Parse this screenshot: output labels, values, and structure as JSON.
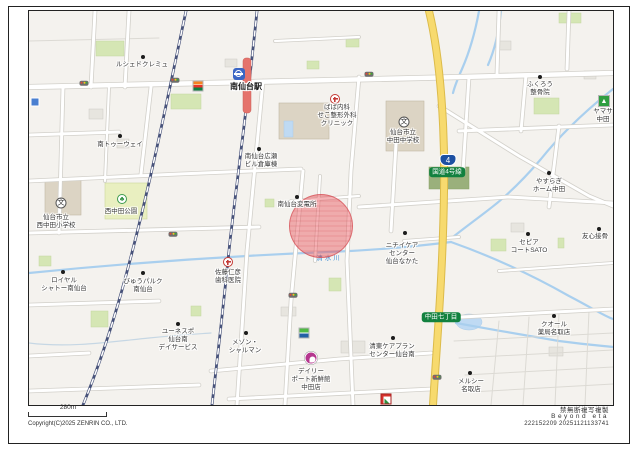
{
  "footer": {
    "scale_label": "280m",
    "copyright": "Copyright(C)2025 ZENRIN CO., LTD.",
    "no_copy_notice": "禁無断複写複製",
    "brand": "Beyond eta",
    "serial": "222152209 20251121133741"
  },
  "map": {
    "colors": {
      "background": "#f4f2ee",
      "route_yellow": "#f7da6e",
      "highlight_red": "#e85560",
      "badge_green": "#12813f",
      "shield_blue": "#1d50a2",
      "river_blue": "#a9cfee",
      "platform_red": "#e5736c"
    },
    "river_label": {
      "text": "清水川",
      "x": 300,
      "y": 246
    },
    "highlight_circle": {
      "x": 291,
      "y": 214,
      "r": 31,
      "fill": "rgba(232,85,92,0.45)",
      "border": "rgba(205,60,68,0.55)"
    },
    "road_labels": [
      {
        "type": "shield",
        "text": "4",
        "x": 419,
        "y": 149
      },
      {
        "type": "badge",
        "text": "国道4号線",
        "x": 418,
        "y": 161
      },
      {
        "type": "badge",
        "text": "中田七丁目",
        "x": 412,
        "y": 306
      }
    ],
    "signals": [
      [
        55,
        72
      ],
      [
        146,
        69
      ],
      [
        340,
        63
      ],
      [
        144,
        223
      ],
      [
        264,
        284
      ],
      [
        408,
        366
      ]
    ],
    "pois": [
      {
        "marker": "dot",
        "mx": 114,
        "my": 46,
        "lines": [
          "ルシェドクレミュ"
        ],
        "lx": 113,
        "ly": 50
      },
      {
        "marker": "dot",
        "mx": 91,
        "my": 125,
        "lines": [
          "南トゥーウェイ"
        ],
        "lx": 91,
        "ly": 130
      },
      {
        "marker": "station",
        "mx": 210,
        "my": 63,
        "lines": [
          "南仙台駅"
        ],
        "lx": 217,
        "ly": 71,
        "cls": "station-label"
      },
      {
        "marker": "dot",
        "mx": 230,
        "my": 138,
        "lines": [
          "南仙台広瀬",
          "ビル倉庫棟"
        ],
        "lx": 232,
        "ly": 142
      },
      {
        "marker": "hospital",
        "mx": 306,
        "my": 88,
        "lines": [
          "ばば内科",
          "せこ整形外科",
          "クリニック"
        ],
        "lx": 308,
        "ly": 93
      },
      {
        "marker": "school",
        "mx": 375,
        "my": 111,
        "lines": [
          "仙台市立",
          "中田中学校"
        ],
        "lx": 374,
        "ly": 118
      },
      {
        "marker": "dot",
        "mx": 511,
        "my": 66,
        "lines": [
          "ふくろう",
          "整骨院"
        ],
        "lx": 511,
        "ly": 70
      },
      {
        "marker": "store-yamasa",
        "mx": 575,
        "my": 90,
        "lines": [
          "ヤマサ",
          "中田"
        ],
        "lx": 574,
        "ly": 97
      },
      {
        "marker": "dot",
        "mx": 520,
        "my": 162,
        "lines": [
          "やすらぎ",
          "ホーム中田"
        ],
        "lx": 520,
        "ly": 167
      },
      {
        "marker": "dot",
        "mx": 268,
        "my": 186,
        "lines": [
          "南仙台変電所"
        ],
        "lx": 268,
        "ly": 190
      },
      {
        "marker": "dot",
        "mx": 376,
        "my": 222,
        "lines": [
          "ニチイケア",
          "センター",
          "仙台なかた"
        ],
        "lx": 373,
        "ly": 231
      },
      {
        "marker": "dot",
        "mx": 499,
        "my": 223,
        "lines": [
          "セピア",
          "コートSATO"
        ],
        "lx": 500,
        "ly": 228
      },
      {
        "marker": "dot",
        "mx": 570,
        "my": 218,
        "lines": [
          "友心接骨"
        ],
        "lx": 566,
        "ly": 222
      },
      {
        "marker": "dot",
        "mx": 525,
        "my": 305,
        "lines": [
          "クオール",
          "薬局名取店"
        ],
        "lx": 525,
        "ly": 310
      },
      {
        "marker": "dot",
        "mx": 441,
        "my": 362,
        "lines": [
          "メルシー",
          "名取店"
        ],
        "lx": 442,
        "ly": 367
      },
      {
        "marker": "dot",
        "mx": 364,
        "my": 327,
        "lines": [
          "清東ケアプラン",
          "センター仙台南"
        ],
        "lx": 363,
        "ly": 332
      },
      {
        "marker": "store-daily",
        "mx": 282,
        "my": 347,
        "lines": [
          "デイリー",
          "ポート新鮮館",
          "中田店"
        ],
        "lx": 282,
        "ly": 357
      },
      {
        "marker": "dot",
        "mx": 217,
        "my": 322,
        "lines": [
          "メゾン・",
          "シャルマン"
        ],
        "lx": 216,
        "ly": 328
      },
      {
        "marker": "hospital",
        "mx": 199,
        "my": 251,
        "lines": [
          "佐藤仁彦",
          "歯科医院"
        ],
        "lx": 199,
        "ly": 258
      },
      {
        "marker": "dot",
        "mx": 149,
        "my": 313,
        "lines": [
          "ユーネスポ",
          "仙台南",
          "デイサービス"
        ],
        "lx": 149,
        "ly": 317
      },
      {
        "marker": "dot",
        "mx": 34,
        "my": 261,
        "lines": [
          "ロイヤル",
          "シャトー南仙台"
        ],
        "lx": 35,
        "ly": 266
      },
      {
        "marker": "dot",
        "mx": 114,
        "my": 262,
        "lines": [
          "びゅうパルク",
          "南仙台"
        ],
        "lx": 114,
        "ly": 267
      },
      {
        "marker": "school",
        "mx": 32,
        "my": 192,
        "lines": [
          "仙台市立",
          "西中田小学校"
        ],
        "lx": 27,
        "ly": 203
      },
      {
        "marker": "park",
        "mx": 93,
        "my": 188,
        "lines": [
          "西中田公園"
        ],
        "lx": 92,
        "ly": 197
      },
      {
        "marker": "store-seven",
        "mx": 169,
        "my": 75
      },
      {
        "marker": "store-famima",
        "mx": 275,
        "my": 322
      },
      {
        "marker": "store-red",
        "mx": 357,
        "my": 388
      },
      {
        "marker": "store-blue",
        "mx": 6,
        "my": 91
      }
    ]
  }
}
